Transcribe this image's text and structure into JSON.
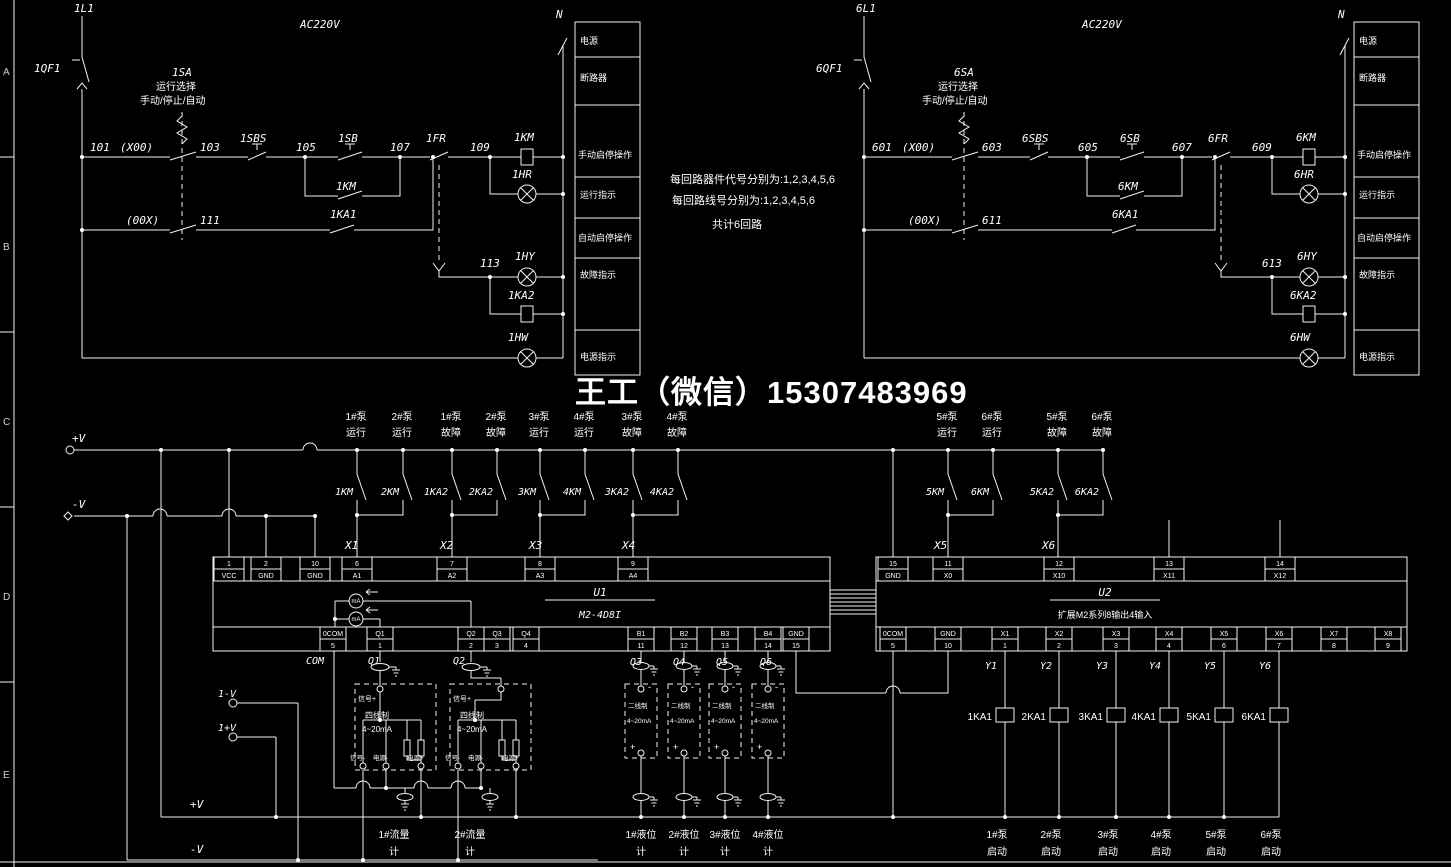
{
  "watermark": {
    "text": "王工（微信）15307483969",
    "color": "#3a3ad6"
  },
  "frame": {
    "letters": [
      "A",
      "B",
      "C",
      "D",
      "E"
    ]
  },
  "notes": {
    "l1": "每回路器件代号分别为:1,2,3,4,5,6",
    "l2": "每回路线号分别为:1,2,3,4,5,6",
    "l3": "共计6回路"
  },
  "legend": {
    "rows": [
      "电源",
      "断路器",
      "手动启停操作",
      "运行指示",
      "自动启停操作",
      "故障指示",
      "电源指示"
    ]
  },
  "c1": {
    "line": "1L1",
    "breaker": "1QF1",
    "voltage": "AC220V",
    "neutral": "N",
    "sa": "1SA",
    "sa1": "运行选择",
    "sa2": "手动/停止/自动",
    "n101": "101",
    "x00": "(X00)",
    "n103": "103",
    "sbs": "1SBS",
    "n105": "105",
    "sb": "1SB",
    "kmaux": "1KM",
    "n107": "107",
    "fr": "1FR",
    "n109": "109",
    "km": "1KM",
    "hr": "1HR",
    "oox": "(00X)",
    "n111": "111",
    "ka1": "1KA1",
    "n113": "113",
    "hy": "1HY",
    "ka2": "1KA2",
    "hw": "1HW"
  },
  "c6": {
    "line": "6L1",
    "breaker": "6QF1",
    "voltage": "AC220V",
    "neutral": "N",
    "sa": "6SA",
    "sa1": "运行选择",
    "sa2": "手动/停止/自动",
    "n101": "601",
    "x00": "(X00)",
    "n103": "603",
    "sbs": "6SBS",
    "n105": "605",
    "sb": "6SB",
    "kmaux": "6KM",
    "n107": "607",
    "fr": "6FR",
    "n109": "609",
    "km": "6KM",
    "hr": "6HR",
    "oox": "(00X)",
    "n111": "611",
    "ka1": "6KA1",
    "n113": "613",
    "hy": "6HY",
    "ka2": "6KA2",
    "hw": "6HW"
  },
  "bus": {
    "plus": "+V",
    "minus": "-V"
  },
  "left_contacts": {
    "labels": [
      [
        "1#泵",
        "运行"
      ],
      [
        "2#泵",
        "运行"
      ],
      [
        "1#泵",
        "故障"
      ],
      [
        "2#泵",
        "故障"
      ],
      [
        "3#泵",
        "运行"
      ],
      [
        "4#泵",
        "运行"
      ],
      [
        "3#泵",
        "故障"
      ],
      [
        "4#泵",
        "故障"
      ]
    ],
    "names": [
      "1KM",
      "2KM",
      "1KA2",
      "2KA2",
      "3KM",
      "4KM",
      "3KA2",
      "4KA2"
    ]
  },
  "right_contacts": {
    "labels": [
      [
        "5#泵",
        "运行"
      ],
      [
        "6#泵",
        "运行"
      ],
      [
        "5#泵",
        "故障"
      ],
      [
        "6#泵",
        "故障"
      ]
    ],
    "names": [
      "5KM",
      "6KM",
      "5KA2",
      "6KA2"
    ]
  },
  "xrefs": [
    "X1",
    "X2",
    "X3",
    "X4",
    "X5",
    "X6"
  ],
  "u1": {
    "name": "U1",
    "model": "M2-4D8I",
    "meter": "mA",
    "top": [
      [
        "1",
        "VCC"
      ],
      [
        "2",
        "GND"
      ],
      [
        "10",
        "GND"
      ],
      [
        "6",
        "A1"
      ],
      [
        "7",
        "A2"
      ],
      [
        "8",
        "A3"
      ],
      [
        "9",
        "A4"
      ]
    ],
    "bottom": [
      [
        "0COM",
        "5"
      ],
      [
        "Q1",
        "1"
      ],
      [
        "Q2",
        "2"
      ],
      [
        "Q3",
        "3"
      ],
      [
        "Q4",
        "4"
      ],
      [
        "B1",
        "11"
      ],
      [
        "B2",
        "12"
      ],
      [
        "B3",
        "13"
      ],
      [
        "B4",
        "14"
      ],
      [
        "GND",
        "15"
      ]
    ],
    "wires": [
      "COM",
      "Q1",
      "Q2",
      "Q3",
      "Q4",
      "Q5",
      "Q6"
    ]
  },
  "u2": {
    "name": "U2",
    "model": "扩展M2系列8输出4输入",
    "top": [
      [
        "15",
        "GND"
      ],
      [
        "11",
        "X0"
      ],
      [
        "12",
        "X10"
      ],
      [
        "13",
        "X11"
      ],
      [
        "14",
        "X12"
      ]
    ],
    "bottom": [
      [
        "0COM",
        "5"
      ],
      [
        "GND",
        "10"
      ],
      [
        "X1",
        "1"
      ],
      [
        "X2",
        "2"
      ],
      [
        "X3",
        "3"
      ],
      [
        "X4",
        "4"
      ],
      [
        "X5",
        "6"
      ],
      [
        "X6",
        "7"
      ],
      [
        "X7",
        "8"
      ],
      [
        "X8",
        "9"
      ]
    ],
    "ys": [
      "Y1",
      "Y2",
      "Y3",
      "Y4",
      "Y5",
      "Y6"
    ],
    "relays": [
      "1KA1",
      "2KA1",
      "3KA1",
      "4KA1",
      "5KA1",
      "6KA1"
    ],
    "pumps": [
      [
        "1#泵",
        "启动"
      ],
      [
        "2#泵",
        "启动"
      ],
      [
        "3#泵",
        "启动"
      ],
      [
        "4#泵",
        "启动"
      ],
      [
        "5#泵",
        "启动"
      ],
      [
        "6#泵",
        "启动"
      ]
    ]
  },
  "flow": {
    "vminus": "1-V",
    "vplus": "1+V",
    "sigplus": "信号+",
    "wiretype": "四线制",
    "range": "4~20mA",
    "sigminus": "信号-",
    "pwrminus": "电源-",
    "pwrplus": "电源+",
    "meters": [
      [
        "1#流量",
        "计"
      ],
      [
        "2#流量",
        "计"
      ]
    ]
  },
  "level": {
    "wiretype": "二线制",
    "range": "4~20mA",
    "minus": "-",
    "plus": "+",
    "meters": [
      [
        "1#液位",
        "计"
      ],
      [
        "2#液位",
        "计"
      ],
      [
        "3#液位",
        "计"
      ],
      [
        "4#液位",
        "计"
      ]
    ]
  },
  "bottom_bus": {
    "plus": "+V",
    "minus": "-V"
  }
}
